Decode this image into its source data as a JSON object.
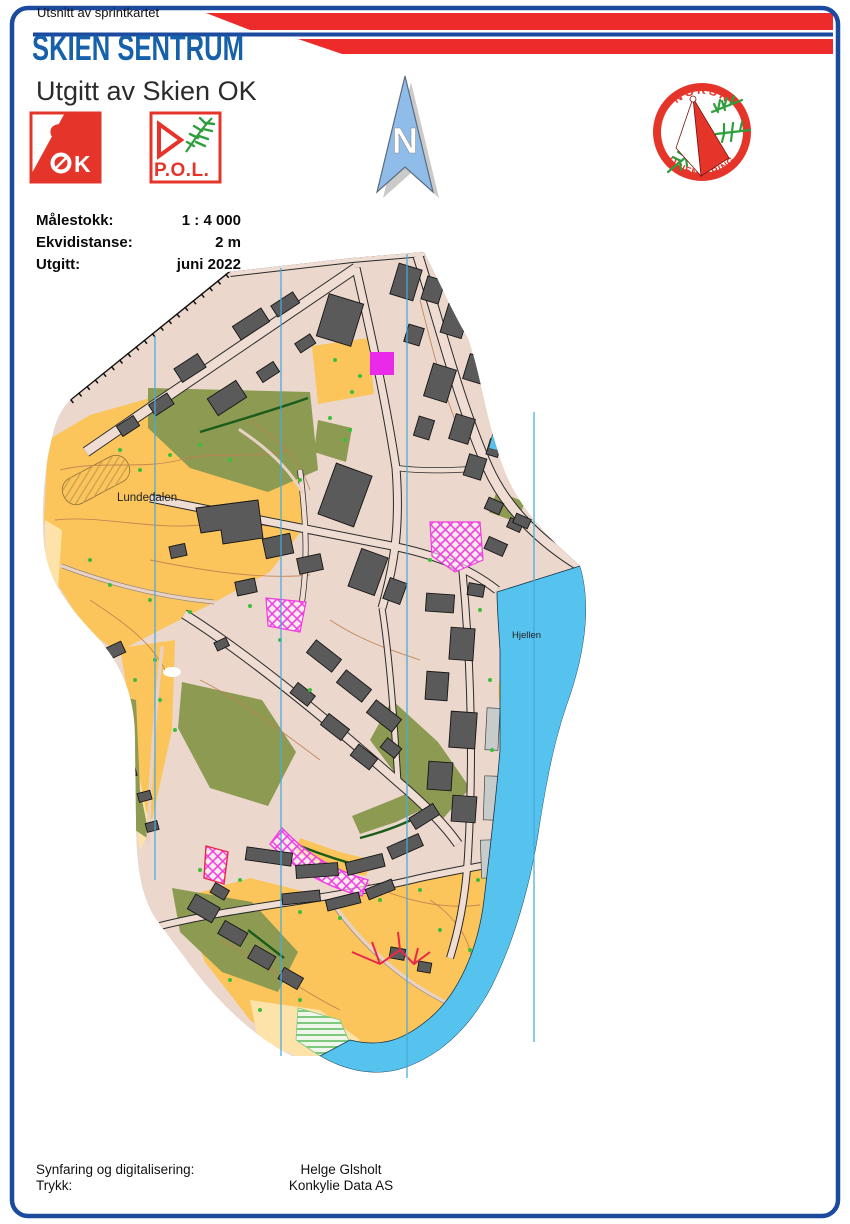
{
  "header": {
    "kicker": "Utsnitt av sprintkartet",
    "title": "SKIEN SENTRUM",
    "subtitle": "Utgitt av Skien OK"
  },
  "info": {
    "r1_label": "Målestokk:",
    "r1_value": "1 : 4 000",
    "r2_label": "Ekvidistanse:",
    "r2_value": "2 m",
    "r3_label": "Utgitt:",
    "r3_value": "juni 2022"
  },
  "north_arrow": {
    "letter": "N"
  },
  "org_logo": {
    "top": "NORSK",
    "bottom": "ORIENTERING"
  },
  "club_logos": {
    "sok_s": "S",
    "sok_k": "K",
    "pol_label": "P.O.L."
  },
  "map": {
    "label_lundedalen": "Lundedalen",
    "label_hjellen": "Hjellen"
  },
  "footer": {
    "r1_label": "Synfaring og digitalisering:",
    "r1_value": "Helge Glsholt",
    "r2_label": "Trykk:",
    "r2_value": "Konkylie Data AS"
  },
  "colors": {
    "border_blue": "#1B4A9E",
    "title_blue": "#1761AB",
    "flag_red": "#EE2B2B",
    "map_paved": "#EBD7CC",
    "map_yellow": "#FBC55C",
    "map_pale_yellow": "#FDE2A9",
    "map_olive": "#8C9A52",
    "map_building_gray": "#5A5A5A",
    "map_water_blue": "#56C2EE",
    "map_magenta": "#E92BE9",
    "meridian_blue": "#45AADF",
    "contour_brown": "#C08050",
    "logo_red": "#E5352B",
    "logo_green": "#2E9E3C"
  }
}
